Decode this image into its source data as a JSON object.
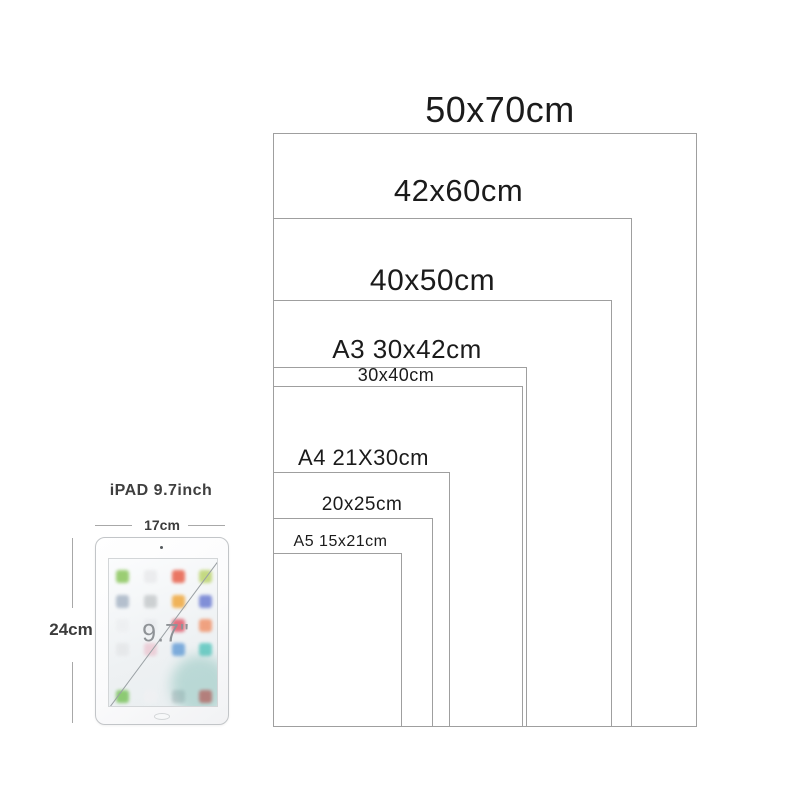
{
  "sizes": [
    {
      "label": "50x70cm",
      "width_cm": 50,
      "height_cm": 70
    },
    {
      "label": "42x60cm",
      "width_cm": 42,
      "height_cm": 60
    },
    {
      "label": "40x50cm",
      "width_cm": 40,
      "height_cm": 50
    },
    {
      "label": "A3 30x42cm",
      "width_cm": 30,
      "height_cm": 42
    },
    {
      "label": "30x40cm",
      "width_cm": 30,
      "height_cm": 40
    },
    {
      "label": "A4 21X30cm",
      "width_cm": 21,
      "height_cm": 30
    },
    {
      "label": "20x25cm",
      "width_cm": 20,
      "height_cm": 25
    },
    {
      "label": "A5 15x21cm",
      "width_cm": 15,
      "height_cm": 21
    }
  ],
  "ipad": {
    "title": "iPAD 9.7inch",
    "width_label": "17cm",
    "height_label": "24cm",
    "diagonal_label": "9.7\""
  },
  "colors": {
    "background": "#ffffff",
    "box_border": "#9f9f9f",
    "size_label_text": "#1b1b1b",
    "measure_line": "#a8a8a8",
    "measure_text": "#3c3c3c",
    "ipad_border": "#c2c5c8",
    "diagonal_line": "#9aa0a4",
    "diagonal_text": "#8e9296"
  }
}
